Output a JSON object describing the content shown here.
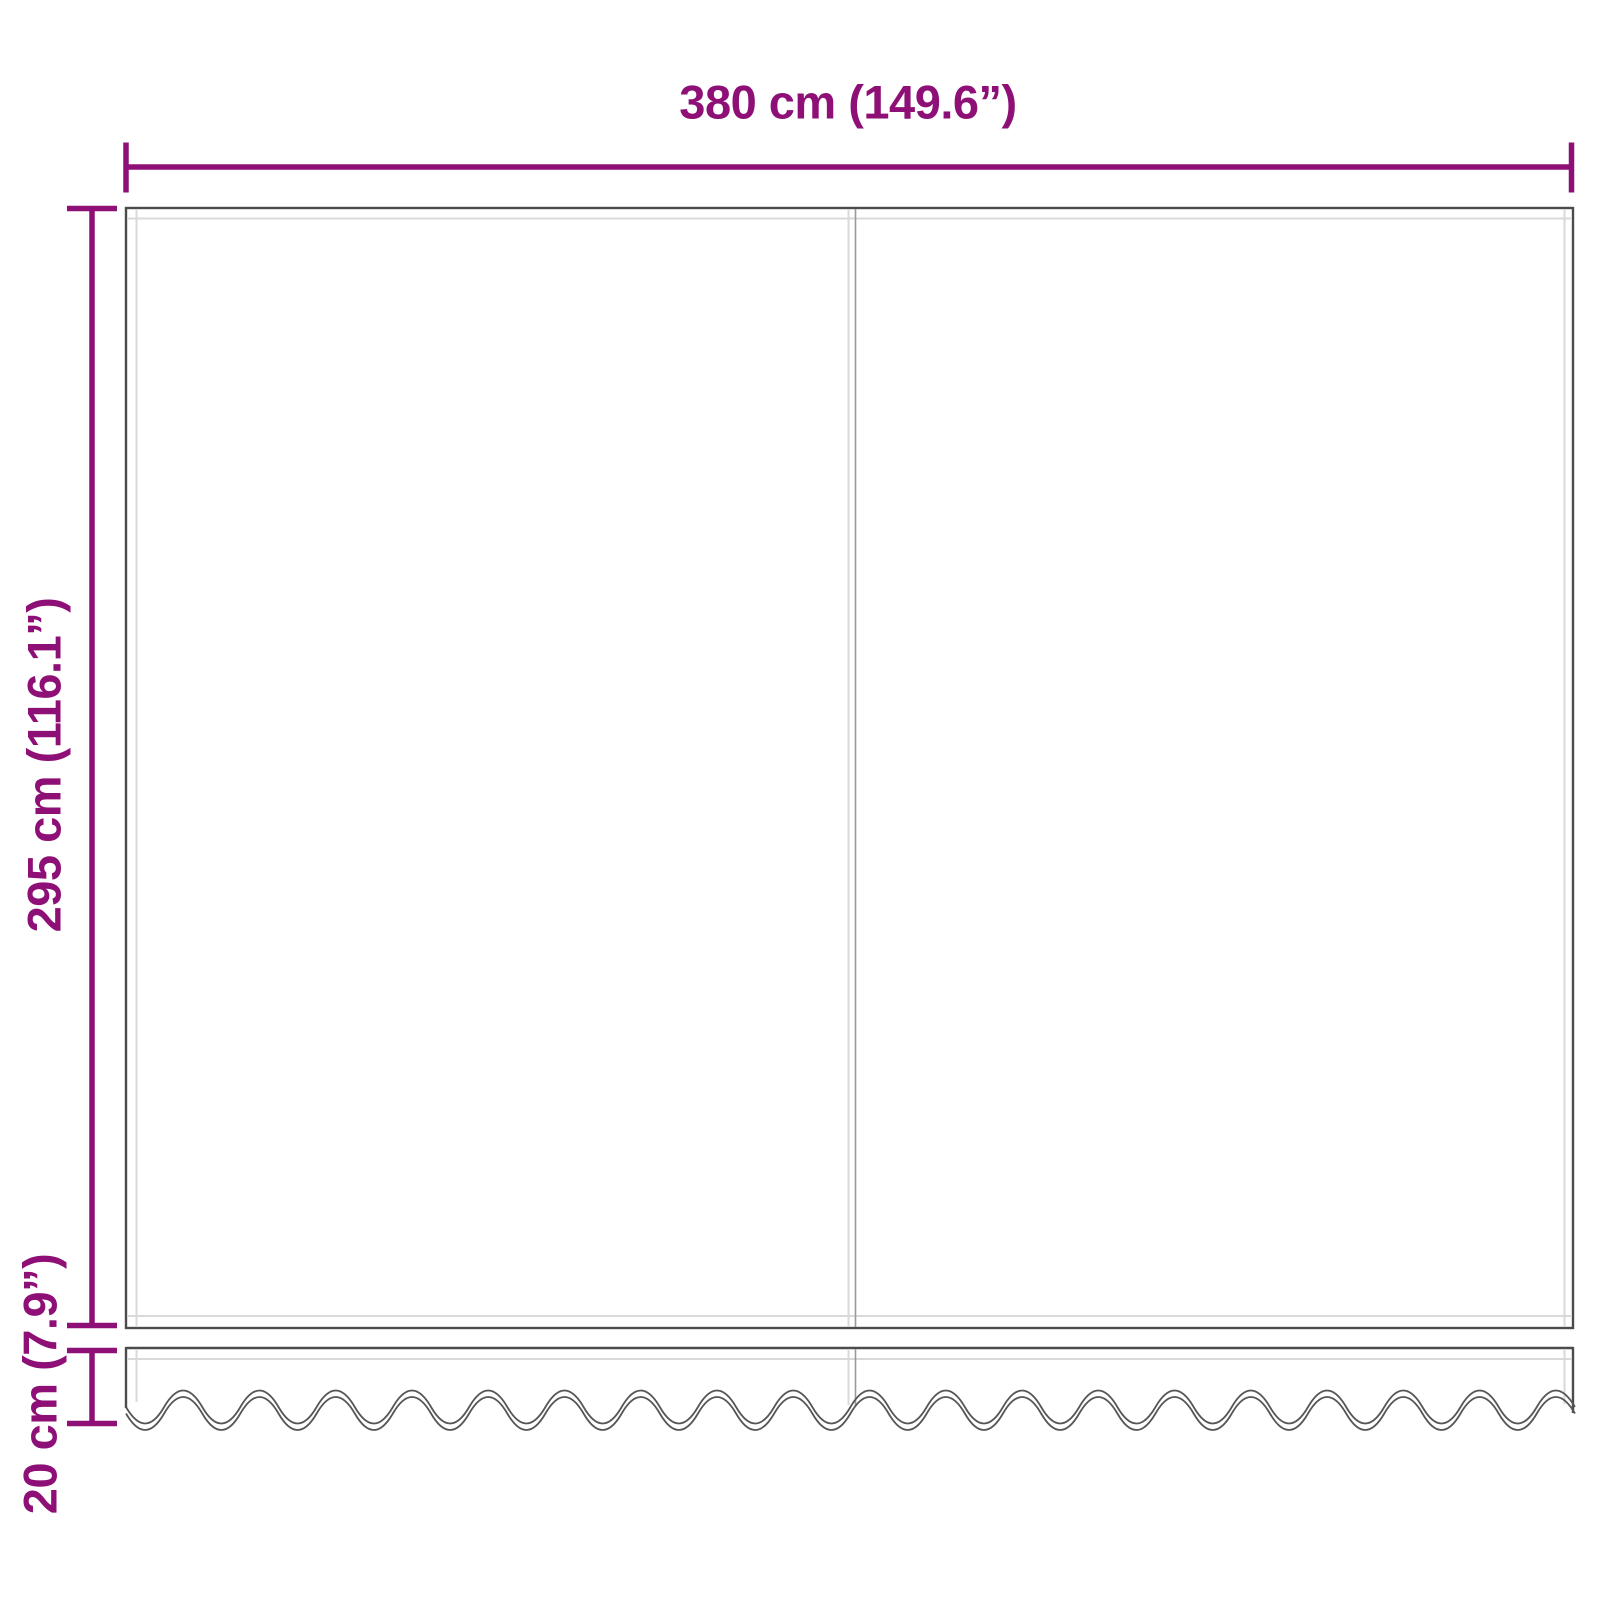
{
  "diagram": {
    "name": "awning-replacement-fabric-with-valance-dimension-drawing",
    "dimensions": {
      "width_label": "380 cm (149.6”)",
      "height_label": "295 cm (116.1”)",
      "valance_label": "20 cm (7.9”)"
    },
    "parts": {
      "main_panel": "awning fabric panel (two sections with center seam)",
      "valance": "scalloped wavy-edge valance strip"
    },
    "colors": {
      "dimension_line": "#8e1077",
      "fabric_outline": "#4c4c4c",
      "hem_line": "#d9d9d9",
      "seam_line": "#9a9a9a",
      "background": "#ffffff"
    }
  }
}
